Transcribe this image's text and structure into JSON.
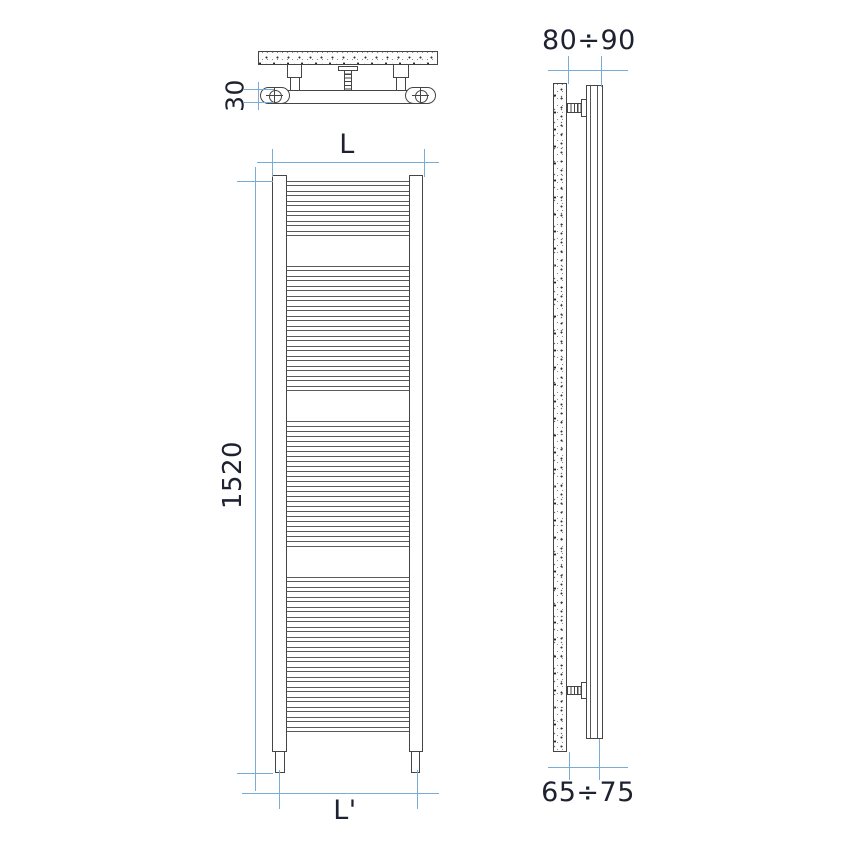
{
  "diagram": {
    "kind": "technical-installation-drawing",
    "subject": "vertical ladder towel-warmer radiator with wall brackets, three orthographic views",
    "colors": {
      "outline": "#454545",
      "dimension_line": "#79ADD7",
      "label_text": "#1D2130",
      "background": "#FFFFFF"
    },
    "labels": {
      "bracket_rail_depth": "30",
      "overall_width": "L",
      "overall_height": "1520",
      "base_centres_width": "L'",
      "wall_offset_top": "80÷90",
      "wall_offset_bottom": "65÷75"
    },
    "front_radiator": {
      "rung_groups": [
        6,
        13,
        13,
        16
      ],
      "rung_pitch_px": 10,
      "rung_height_px": 5.2,
      "group_gap_px": 30,
      "first_rung_top_px": 181
    }
  }
}
